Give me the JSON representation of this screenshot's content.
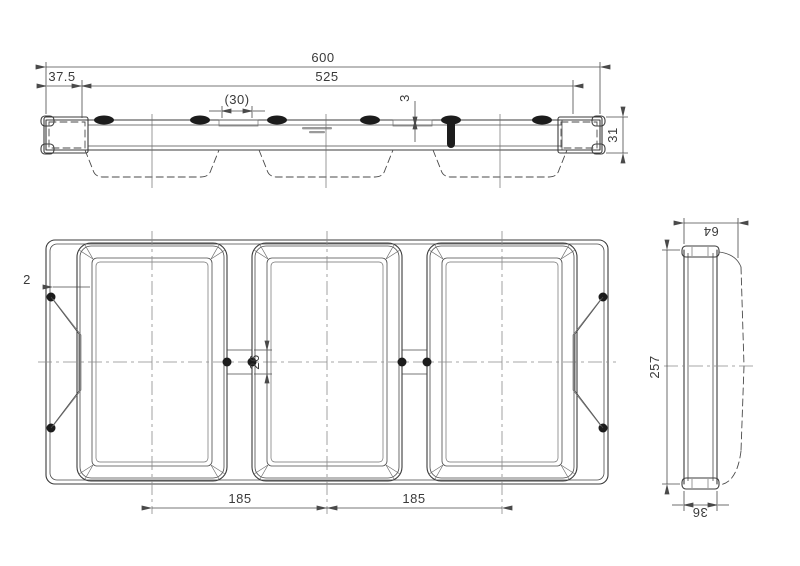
{
  "drawing": {
    "type": "engineering-drawing",
    "line_color": "#3b3b3b",
    "background": "#ffffff",
    "views": {
      "top_view": {
        "label": "top profile view",
        "dims": {
          "overall_width": "600",
          "inner_span": "525",
          "end_offset": "37.5",
          "gap_width": "(30)",
          "wall_thickness": "3",
          "profile_height": "31"
        }
      },
      "front_view": {
        "label": "front view (three compartments)",
        "dims": {
          "wall_thickness": "2",
          "bridge_height": "26",
          "pitch_left": "185",
          "pitch_right": "185"
        }
      },
      "side_view": {
        "label": "side section view",
        "dims": {
          "depth": "64",
          "overall_height": "257",
          "rim_depth": "36"
        }
      }
    }
  }
}
